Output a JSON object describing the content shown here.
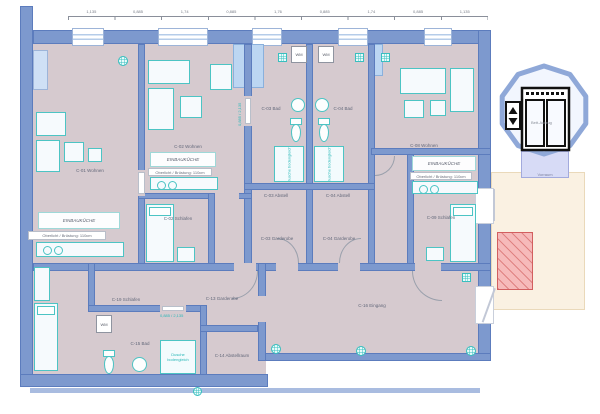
{
  "plan_title": "",
  "dims": [
    "1,135",
    "0,885",
    "1,74",
    "0,885",
    "1,76",
    "0,885",
    "1,74",
    "0,885",
    "1,135"
  ],
  "rooms": [
    {
      "label": "C-01 Wohnen"
    },
    {
      "label": "C-02 Wohnen"
    },
    {
      "label": "C-02 Schlafen"
    },
    {
      "label": "C-03 Bad"
    },
    {
      "label": "C-04 Bad"
    },
    {
      "label": "C-03 Abstell"
    },
    {
      "label": "C-04 Abstell"
    },
    {
      "label": "C-03 Garderobe"
    },
    {
      "label": "C-04 Garderobe"
    },
    {
      "label": "C-08 Wohnen"
    },
    {
      "label": "C-09 Schlafen"
    },
    {
      "label": "C-16 Eingang"
    },
    {
      "label": "C-19 Schlafen"
    },
    {
      "label": "C-15 Bad"
    },
    {
      "label": "C-13 Garderobe"
    },
    {
      "label": "C-14 Abstellraum"
    }
  ],
  "kitchen": {
    "unit_label": "EINBAUKÜCHE",
    "sill_note": "Oberlicht / Brüstung: 110cm"
  },
  "fixtures": {
    "washer_label": "WM",
    "shower_label": "Dusche bodengleich",
    "door_spec": "0,885 / 2,135"
  },
  "elevator": {
    "label": "Bett-Aufzug",
    "vestibule": "Vorraum",
    "up": "▲",
    "down": "▼"
  },
  "colors": {
    "wall": "#7d99ce",
    "floor": "#d6cacf",
    "furniture_stroke": "#4cc4c4",
    "glazing": "#b5cce9",
    "accent_teal": "#2ab8b8",
    "stair_hatch": "#d25f5f",
    "exterior_area": "#faf1e2",
    "elevator_ring": "#8fa8d8"
  },
  "icons": {
    "ceiling_spot": "grid-circle",
    "washing_machine": "WM",
    "elevator_up": "▲",
    "elevator_down": "▼"
  }
}
